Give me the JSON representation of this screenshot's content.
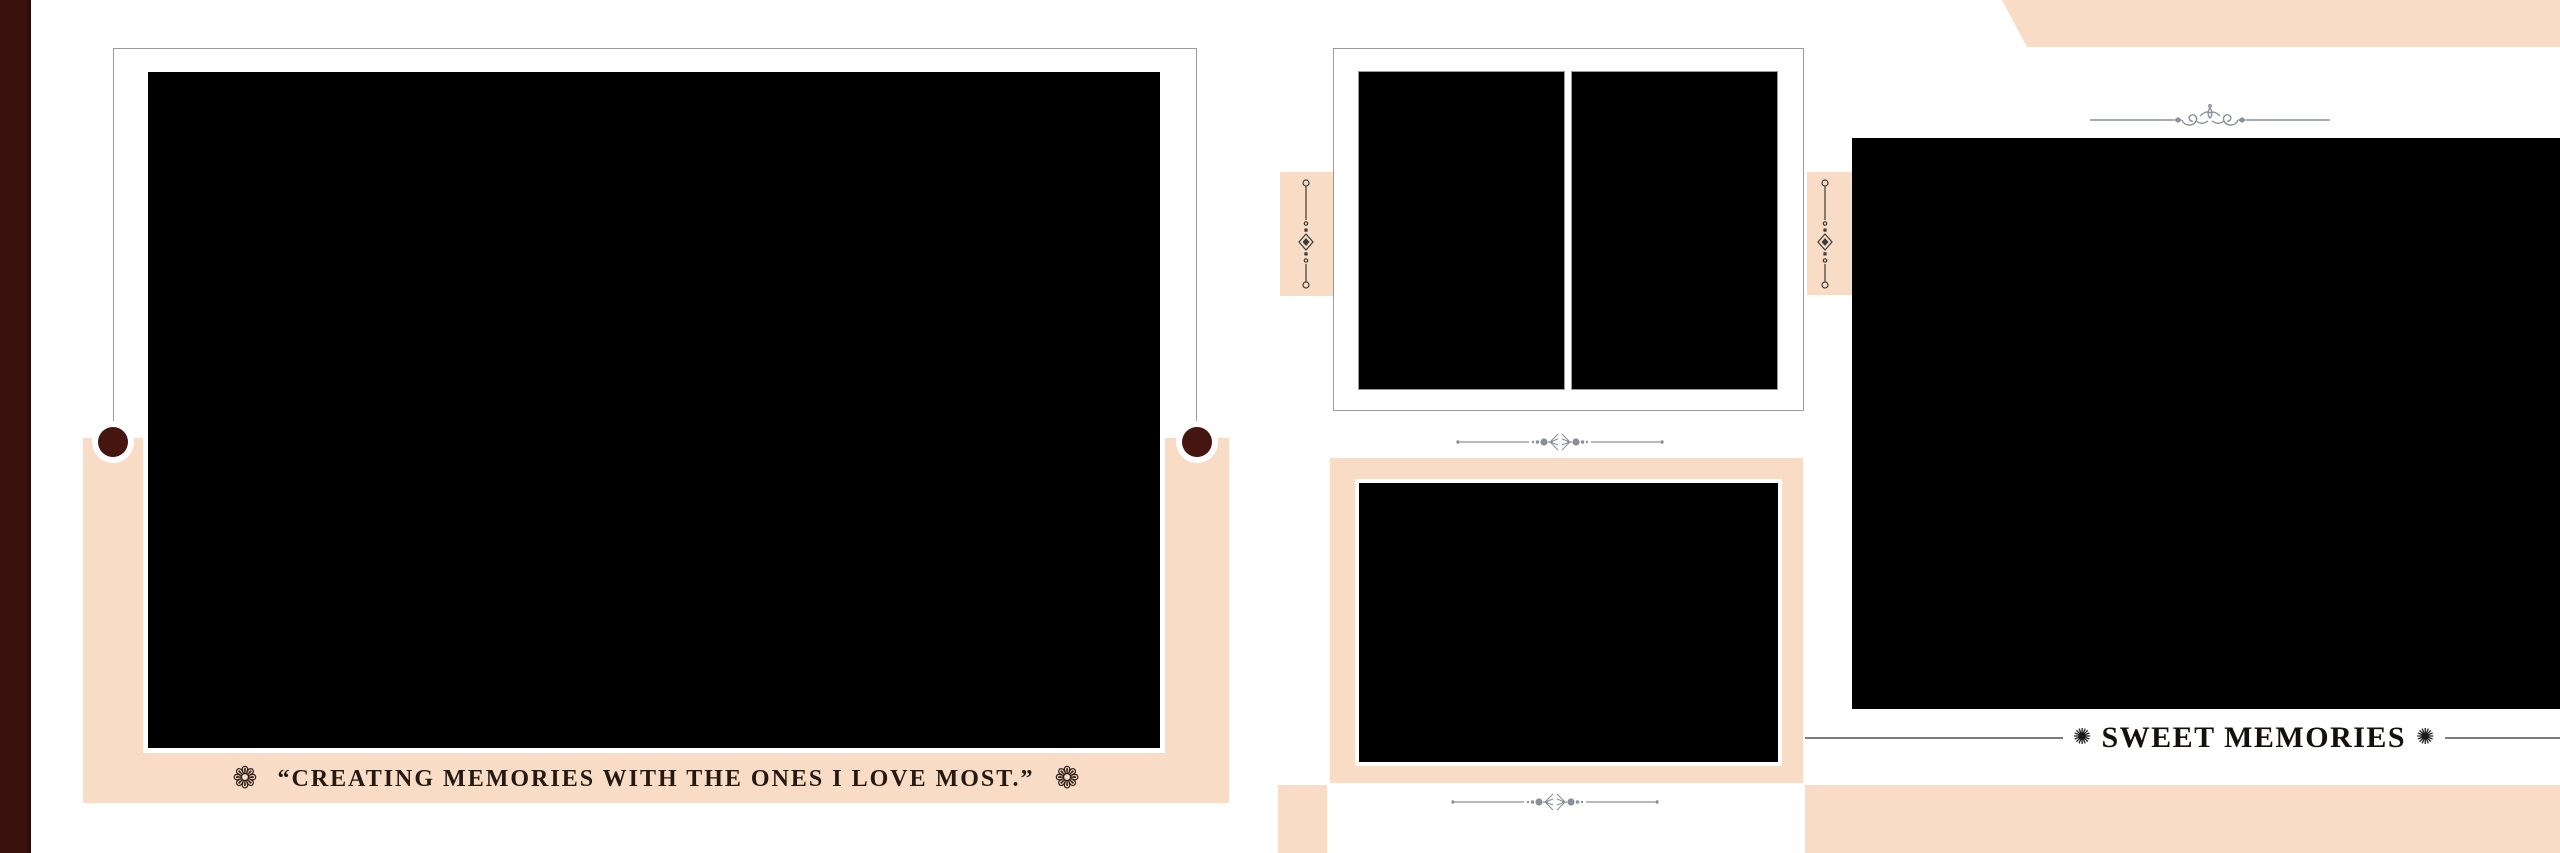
{
  "canvas": {
    "width_px": 2560,
    "height_px": 853,
    "background": "#ffffff"
  },
  "palette": {
    "peach": "#f8dcc5",
    "maroon_strip": "#3a110d",
    "pin_circle_maroon": "#44160f",
    "frame_border_gray": "#9a9a9a",
    "divider_gray": "#8a9098",
    "vertical_ornament_dark": "#3b3b3b",
    "caption_text": "#241812",
    "title_text": "#15100c",
    "banner_line_gray": "#7c7c7c"
  },
  "left_panel": {
    "caption": {
      "ornament_left": "❁",
      "text": "“CREATING MEMORIES WITH THE ONES I LOVE MOST.”",
      "ornament_right": "❁"
    }
  },
  "right_panel": {
    "title": {
      "ornament_left": "✺",
      "text": "SWEET MEMORIES",
      "ornament_right": "✺"
    }
  }
}
